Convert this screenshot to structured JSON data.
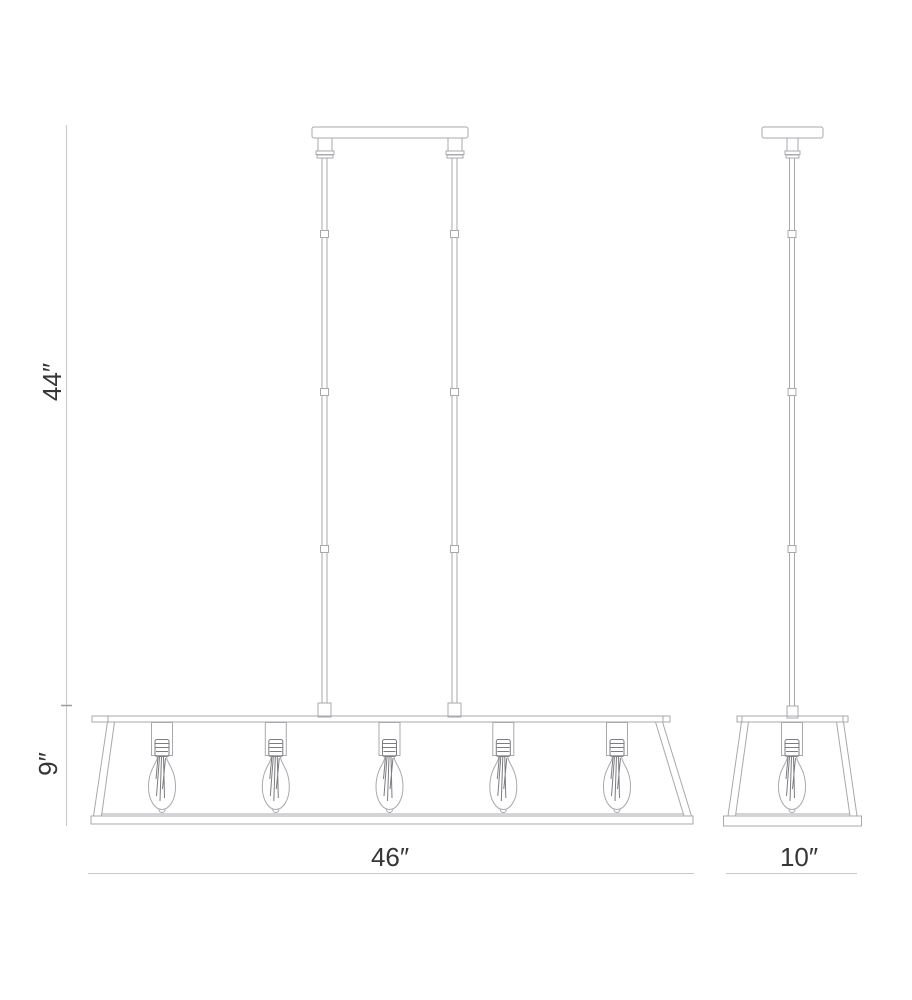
{
  "labels": {
    "drop_height": "44″",
    "shade_height": "9″",
    "fixture_width": "46″",
    "fixture_depth": "10″"
  },
  "fixture": {
    "front_bulb_count": 5,
    "side_bulb_count": 1,
    "bulb_style": "edison-filament",
    "views": [
      "front",
      "side"
    ]
  },
  "colors": {
    "background": "#ffffff",
    "outline": "#a9a9ad",
    "detail": "#7c7c81",
    "dim_line": "#c9c9c9",
    "tick": "#9c9c9c",
    "text": "#363636"
  }
}
